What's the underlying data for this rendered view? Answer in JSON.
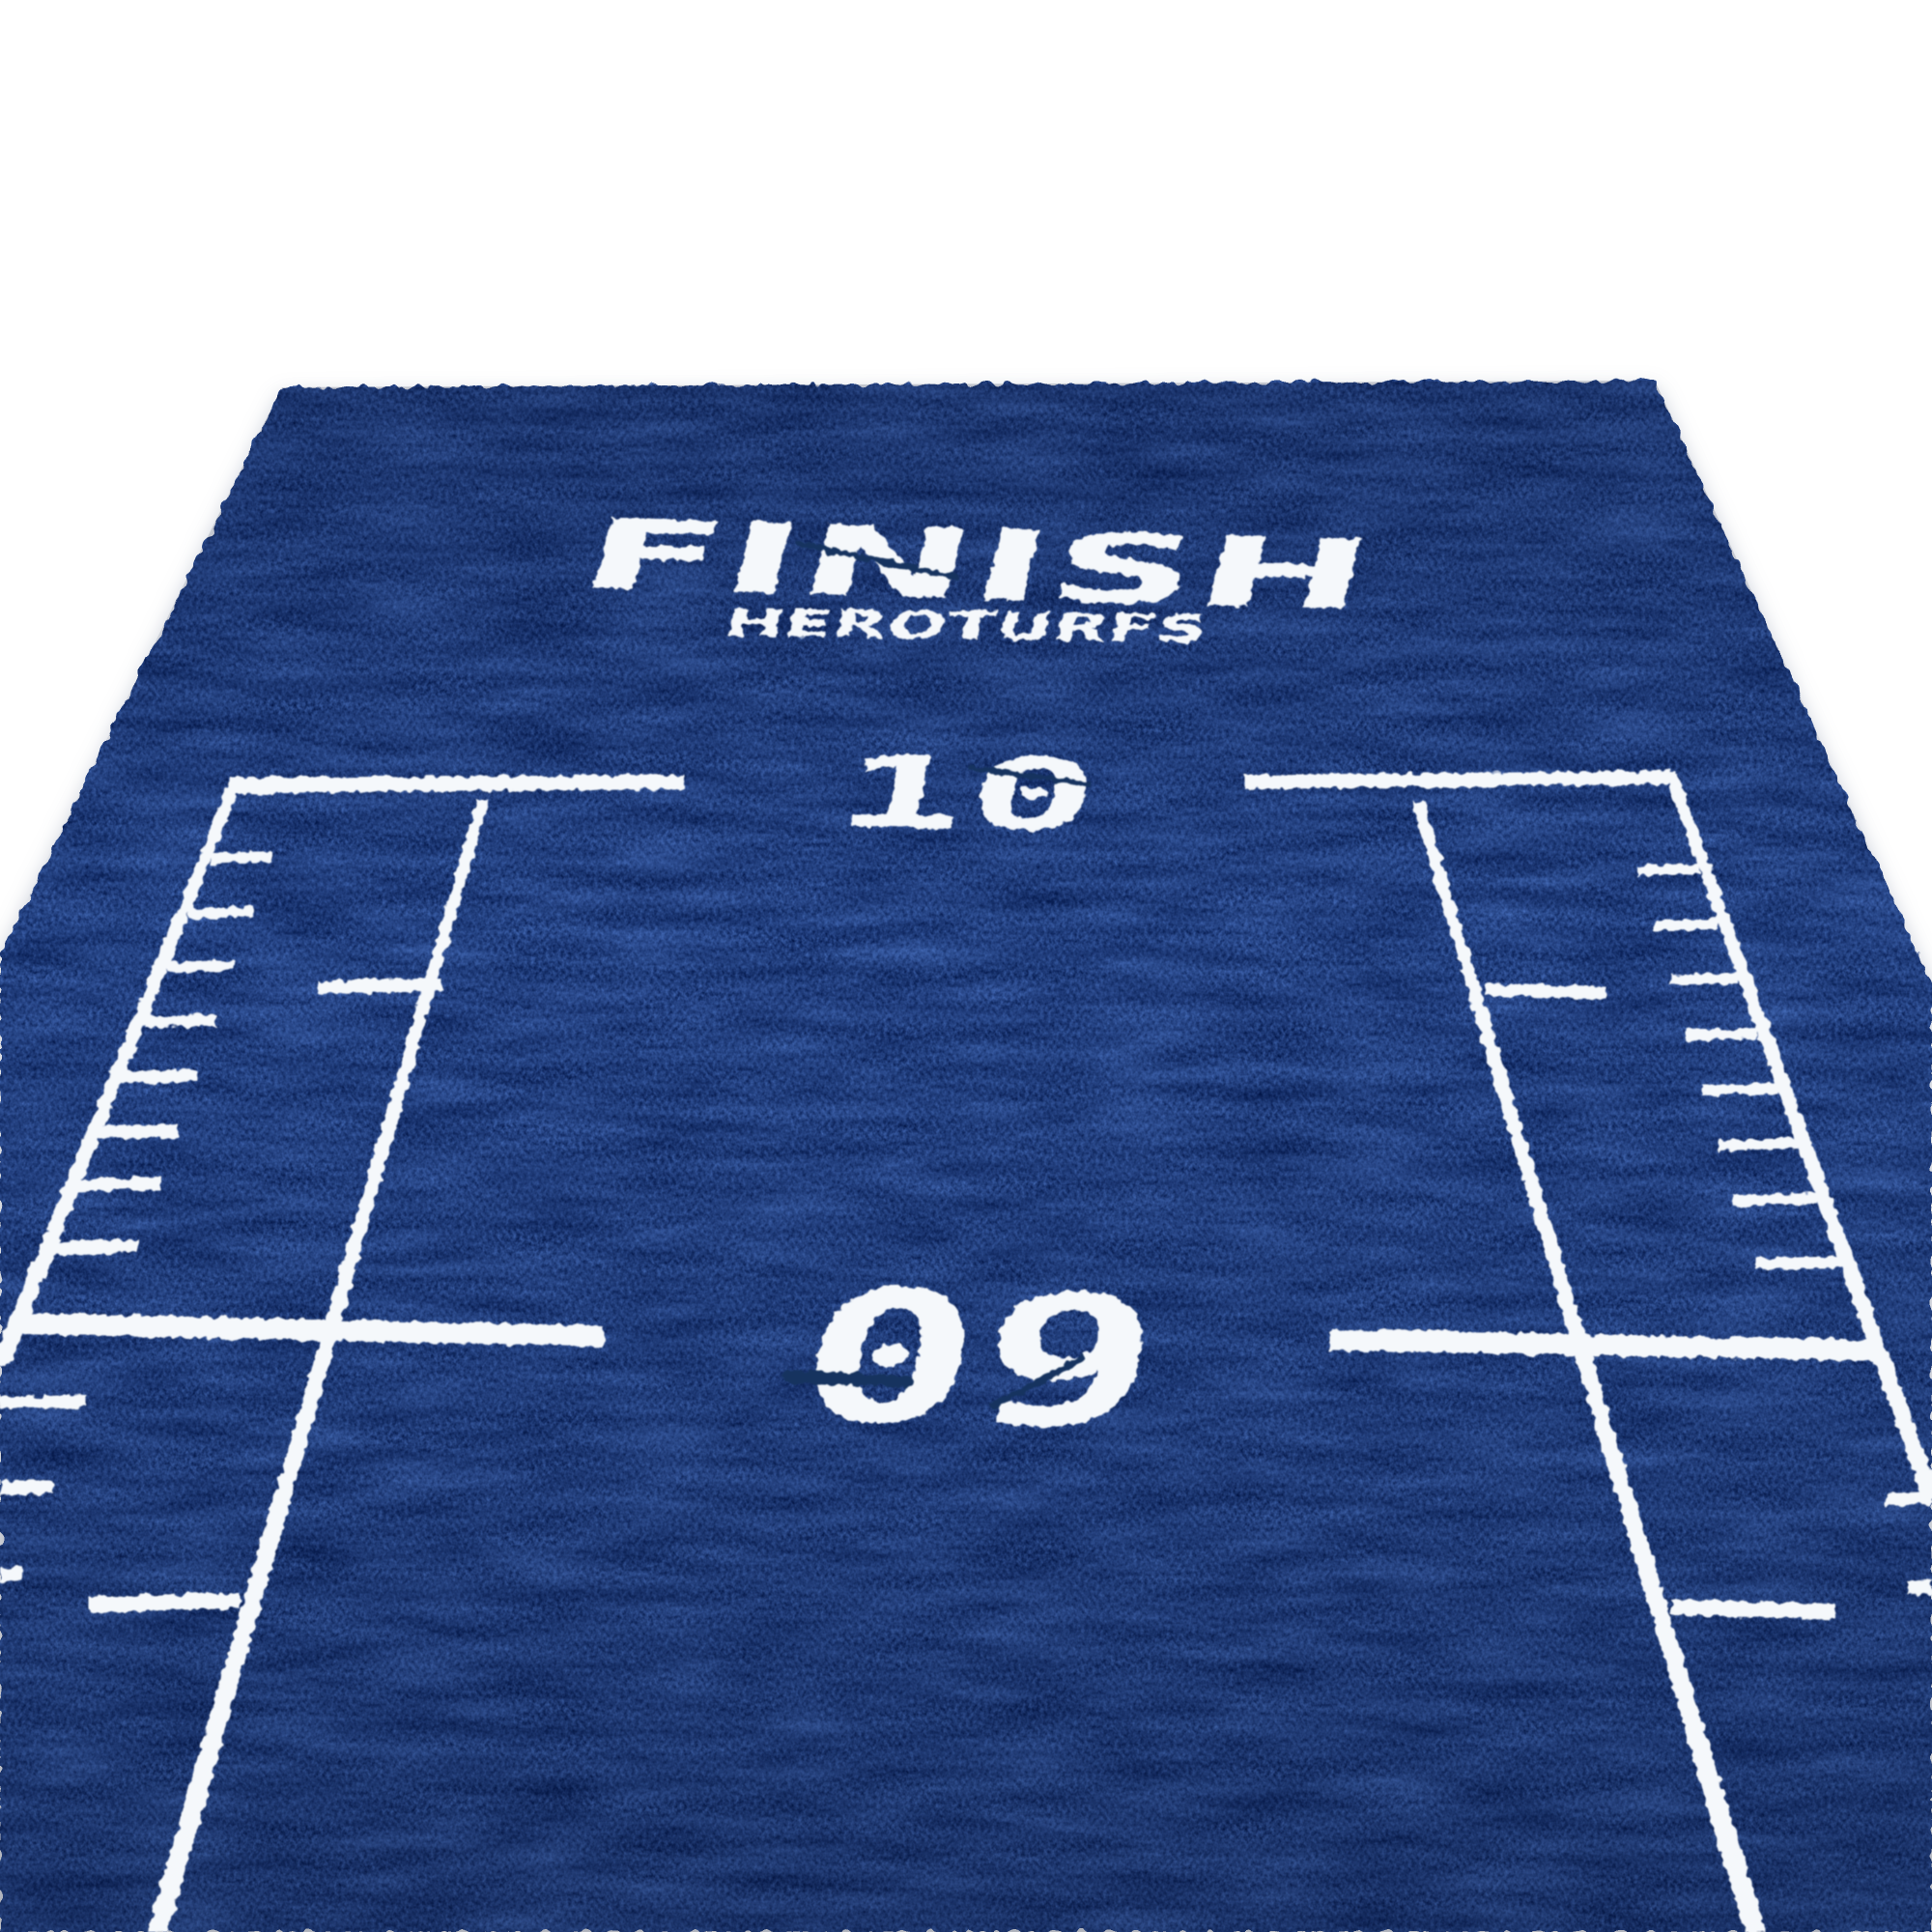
{
  "mat": {
    "finish_label": "FINISH",
    "brand_label": "HEROTURFS",
    "markers": [
      {
        "label": "10"
      },
      {
        "label": "09"
      }
    ],
    "colors": {
      "turf_blue": "#2a4a8c",
      "turf_dark": "#16306b",
      "turf_light": "#6e96d8",
      "paint_white": "#f5f8fb",
      "background": "#ffffff",
      "stencil_cut": "#16335f"
    }
  }
}
